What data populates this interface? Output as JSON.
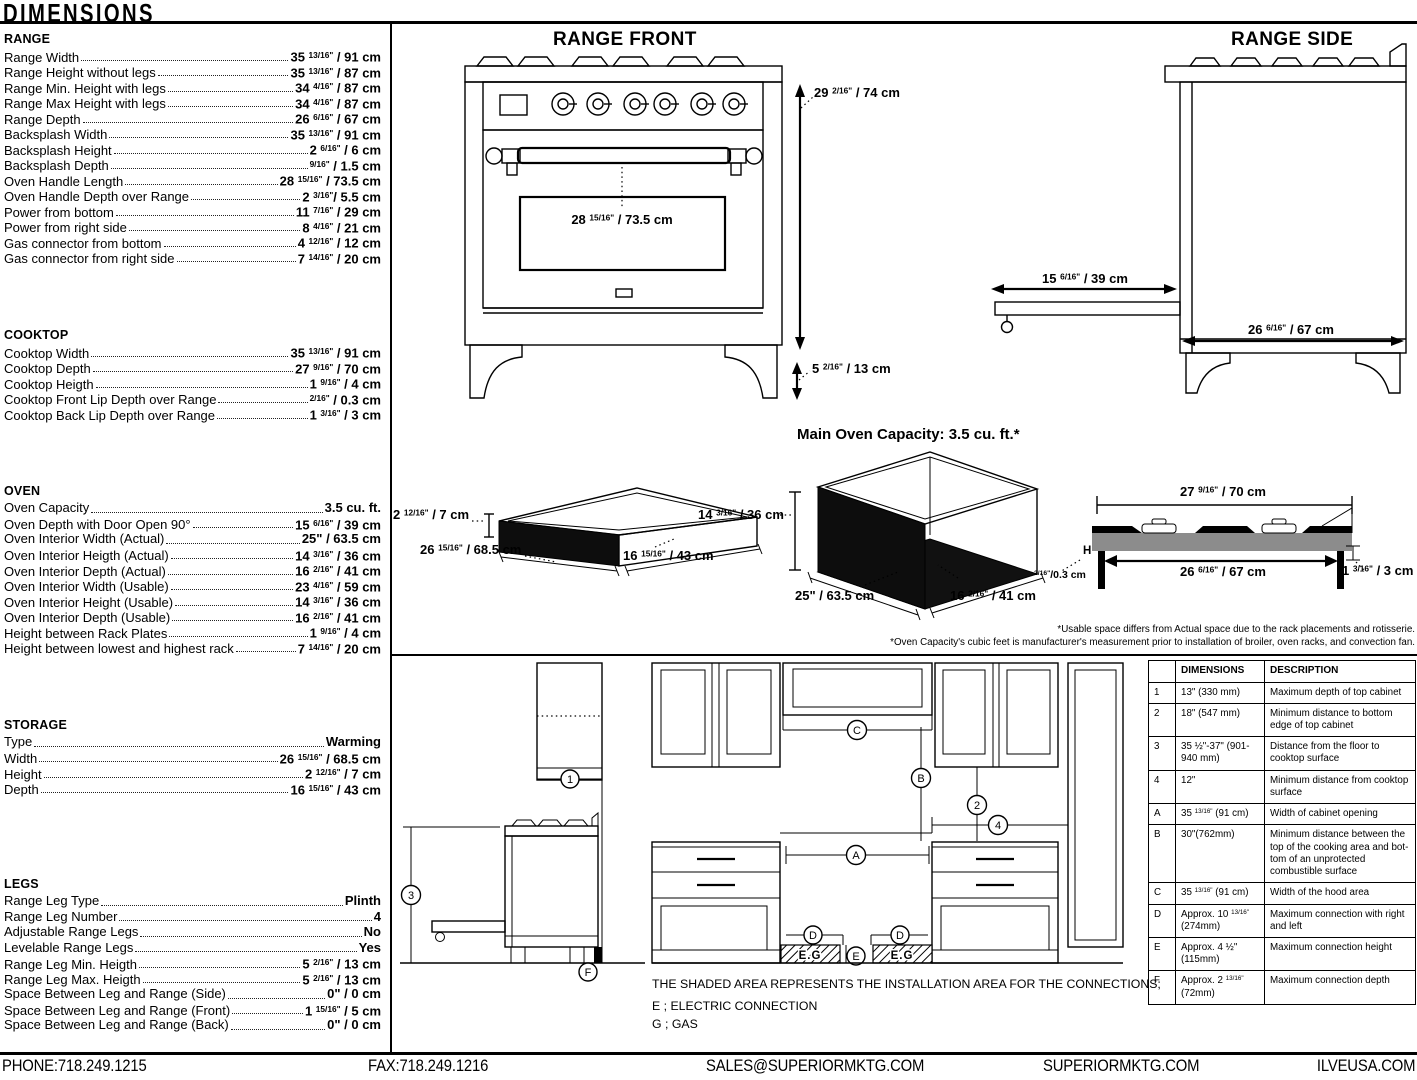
{
  "page": {
    "title": "DIMENSIONS"
  },
  "specs": {
    "sections": [
      {
        "title": "RANGE",
        "rows": [
          {
            "label": "Range Width",
            "value": "35 13/16\" / 91 cm"
          },
          {
            "label": "Range Height without legs",
            "value": "35 13/16\" / 87 cm"
          },
          {
            "label": "Range Min. Height with legs",
            "value": "34 4/16\" / 87 cm"
          },
          {
            "label": "Range Max Height with legs",
            "value": "34 4/16\" / 87 cm"
          },
          {
            "label": "Range Depth",
            "value": "26 6/16\" / 67 cm"
          },
          {
            "label": "Backsplash Width",
            "value": "35 13/16\" / 91 cm"
          },
          {
            "label": "Backsplash Height",
            "value": "2 6/16\" / 6 cm"
          },
          {
            "label": "Backsplash Depth",
            "value": "9/16\" / 1.5 cm"
          },
          {
            "label": "Oven Handle Length",
            "value": "28 15/16\" / 73.5 cm"
          },
          {
            "label": "Oven Handle Depth over Range",
            "value": "2 3/16\"/ 5.5 cm"
          },
          {
            "label": "Power from bottom",
            "value": "11 7/16\" / 29 cm"
          },
          {
            "label": "Power from right side",
            "value": "8 4/16\" / 21 cm"
          },
          {
            "label": "Gas connector from bottom",
            "value": "4 12/16\" / 12 cm"
          },
          {
            "label": "Gas connector from right side",
            "value": "7 14/16\" / 20 cm"
          }
        ]
      },
      {
        "title": "COOKTOP",
        "rows": [
          {
            "label": "Cooktop Width",
            "value": "35 13/16\" / 91 cm"
          },
          {
            "label": "Cooktop Depth",
            "value": "27 9/16\" / 70 cm"
          },
          {
            "label": "Cooktop Heigth",
            "value": "1 9/16\" / 4 cm"
          },
          {
            "label": "Cooktop Front Lip Depth over Range",
            "value": "2/16\" / 0.3 cm"
          },
          {
            "label": "Cooktop Back Lip Depth over Range",
            "value": "1 3/16\" / 3 cm"
          }
        ]
      },
      {
        "title": "OVEN",
        "rows": [
          {
            "label": "Oven Capacity",
            "value": "3.5 cu. ft."
          },
          {
            "label": "Oven Depth with Door Open 90°",
            "value": "15 6/16\" / 39 cm"
          },
          {
            "label": "Oven Interior Width (Actual)",
            "value": "25\" / 63.5 cm"
          },
          {
            "label": "Oven Interior Heigth (Actual)",
            "value": "14 3/16\" / 36 cm"
          },
          {
            "label": "Oven Interior Depth (Actual)",
            "value": "16 2/16\" / 41 cm"
          },
          {
            "label": "Oven Interior Width (Usable)",
            "value": "23 4/16\" / 59 cm"
          },
          {
            "label": "Oven Interior Height (Usable)",
            "value": "14 3/16\" / 36 cm"
          },
          {
            "label": "Oven Interior Depth (Usable)",
            "value": "16 2/16\" / 41 cm"
          },
          {
            "label": "Height between Rack Plates",
            "value": "1 9/16\" / 4 cm"
          },
          {
            "label": "Height between lowest and highest rack",
            "value": "7 14/16\" / 20 cm"
          }
        ]
      },
      {
        "title": "STORAGE",
        "rows": [
          {
            "label": "Type",
            "value": "Warming"
          },
          {
            "label": "Width",
            "value": "26 15/16\" / 68.5 cm"
          },
          {
            "label": "Height",
            "value": "2 12/16\" / 7 cm"
          },
          {
            "label": "Depth",
            "value": "16 15/16\" / 43 cm"
          }
        ]
      },
      {
        "title": "LEGS",
        "rows": [
          {
            "label": "Range Leg Type",
            "value": "Plinth"
          },
          {
            "label": "Range Leg Number",
            "value": "4"
          },
          {
            "label": "Adjustable Range Legs",
            "value": "No"
          },
          {
            "label": "Levelable Range Legs",
            "value": "Yes"
          },
          {
            "label": "Range Leg Min. Heigth",
            "value": "5 2/16\" / 13 cm"
          },
          {
            "label": "Range Leg Max. Heigth",
            "value": "5 2/16\" / 13 cm"
          },
          {
            "label": "Space Between Leg and Range (Side)",
            "value": "0\" / 0 cm"
          },
          {
            "label": "Space Between Leg and Range (Front)",
            "value": "1 15/16\" / 5 cm"
          },
          {
            "label": "Space Between Leg and Range (Back)",
            "value": "0\" / 0 cm"
          }
        ]
      }
    ]
  },
  "diagrams": {
    "titles": {
      "range_front": "RANGE FRONT",
      "range_side": "RANGE SIDE",
      "oven_capacity": "Main Oven Capacity: 3.5 cu. ft.*"
    },
    "dims": {
      "rf_height": "29 2/16\" / 74 cm",
      "rf_handle": "28 15/16\" / 73.5 cm",
      "rf_leg": "5 2/16\" / 13 cm",
      "rs_door": "15 6/16\" / 39 cm",
      "rs_depth": "26 6/16\" / 67 cm",
      "drawer_h": "2 12/16\" / 7 cm",
      "drawer_w": "26 15/16\" / 68.5 cm",
      "drawer_d": "16 15/16\" / 43 cm",
      "oven_h": "14 3/16\" / 36 cm",
      "oven_w": "25\" / 63.5 cm",
      "oven_d": "16 2/16\" / 41 cm",
      "ct_top": "27 9/16\" / 70 cm",
      "ct_bottom": "26 6/16\" / 67 cm",
      "ct_back": "1 3/16\" / 3 cm",
      "ct_front": "2/16\"/0.3 cm",
      "ct_h": "H"
    },
    "footnotes": [
      "*Usable space differs from Actual space due to the rack placements and rotisserie.",
      "*Oven Capacity's cubic feet is manufacturer's measurement prior to installation of broiler, oven racks, and convection fan."
    ]
  },
  "installation": {
    "note": "THE SHADED AREA REPRESENTS THE INSTALLATION AREA FOR THE CONNECTIONS;",
    "legend_e": "E ; ELECTRIC CONNECTION",
    "legend_g": "G ; GAS",
    "eg": "E.G",
    "markers": {
      "n1": "1",
      "n2": "2",
      "n3": "3",
      "n4": "4",
      "A": "A",
      "B": "B",
      "C": "C",
      "D": "D",
      "E": "E",
      "F": "F"
    },
    "table": {
      "headers": {
        "dim": "DIMENSIONS",
        "desc": "DESCRIPTION"
      },
      "rows": [
        {
          "key": "1",
          "dim": "13\" (330 mm)",
          "desc": "Maximum depth of top cabinet"
        },
        {
          "key": "2",
          "dim": "18\" (547 mm)",
          "desc": "Minimum distance to bottom edge of top cabinet"
        },
        {
          "key": "3",
          "dim": "35 ½\"-37\" (901-940 mm)",
          "desc": "Distance from the floor to cooktop surface"
        },
        {
          "key": "4",
          "dim": "12\"",
          "desc": "Minimum distance from cooktop surface"
        },
        {
          "key": "A",
          "dim": "35 13/16\" (91 cm)",
          "desc": "Width of cabinet opening"
        },
        {
          "key": "B",
          "dim": "30\"(762mm)",
          "desc": "Minimum distance between the top of the cooking area and bot- tom of an unprotected combustible surface"
        },
        {
          "key": "C",
          "dim": "35 13/16\" (91 cm)",
          "desc": "Width of the hood area"
        },
        {
          "key": "D",
          "dim": "Approx. 10 13/16\" (274mm)",
          "desc": "Maximum connection with right and left"
        },
        {
          "key": "E",
          "dim": "Approx. 4 ½\" (115mm)",
          "desc": "Maximum connection height"
        },
        {
          "key": "F",
          "dim": "Approx. 2 13/16\" (72mm)",
          "desc": "Maximum connection depth"
        }
      ]
    }
  },
  "footer": {
    "phone": "PHONE:718.249.1215",
    "fax": "FAX:718.249.1216",
    "email": "SALES@SUPERIORMKTG.COM",
    "web": "SUPERIORMKTG.COM",
    "web2": "ILVEUSA.COM"
  }
}
